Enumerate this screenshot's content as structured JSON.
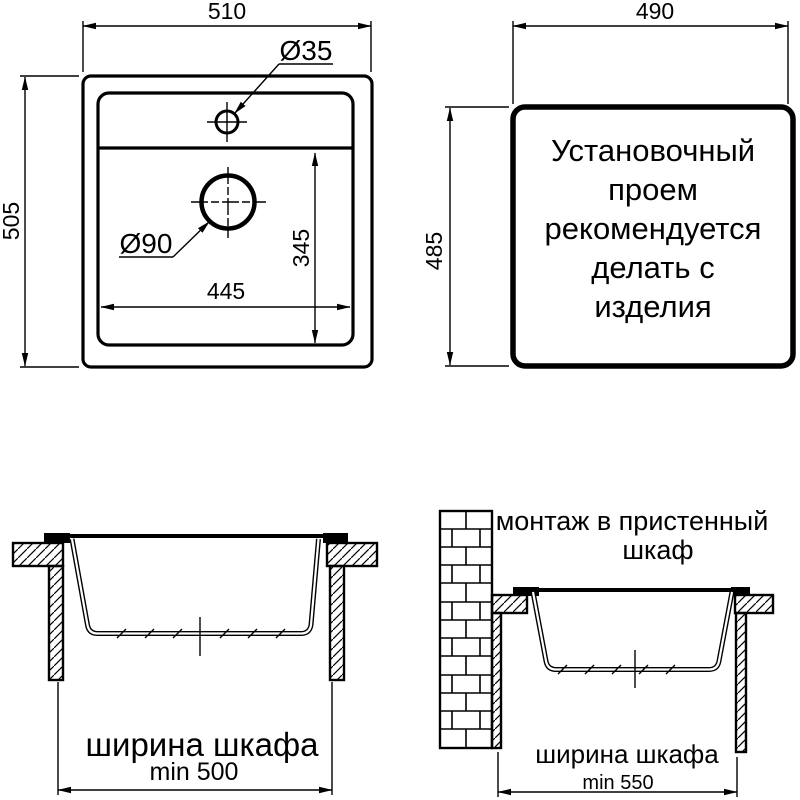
{
  "colors": {
    "ink": "#000000",
    "paper": "#ffffff"
  },
  "views": {
    "top": {
      "overall_width": "510",
      "overall_height": "505",
      "faucet_hole_diameter": "Ø35",
      "drain_hole_diameter": "Ø90",
      "bowl_width": "445",
      "bowl_depth": "345"
    },
    "cutout": {
      "width": "490",
      "height": "485",
      "note_lines": [
        "Установочный",
        "проем",
        "рекомендуется",
        "делать с",
        "изделия"
      ]
    },
    "section_standard": {
      "cabinet_width_label": "ширина шкафа",
      "cabinet_width_min": "min 500"
    },
    "section_wall": {
      "caption_lines": [
        "монтаж в пристенный",
        "шкаф"
      ],
      "cabinet_width_label": "ширина шкафа",
      "cabinet_width_min": "min 550"
    }
  }
}
